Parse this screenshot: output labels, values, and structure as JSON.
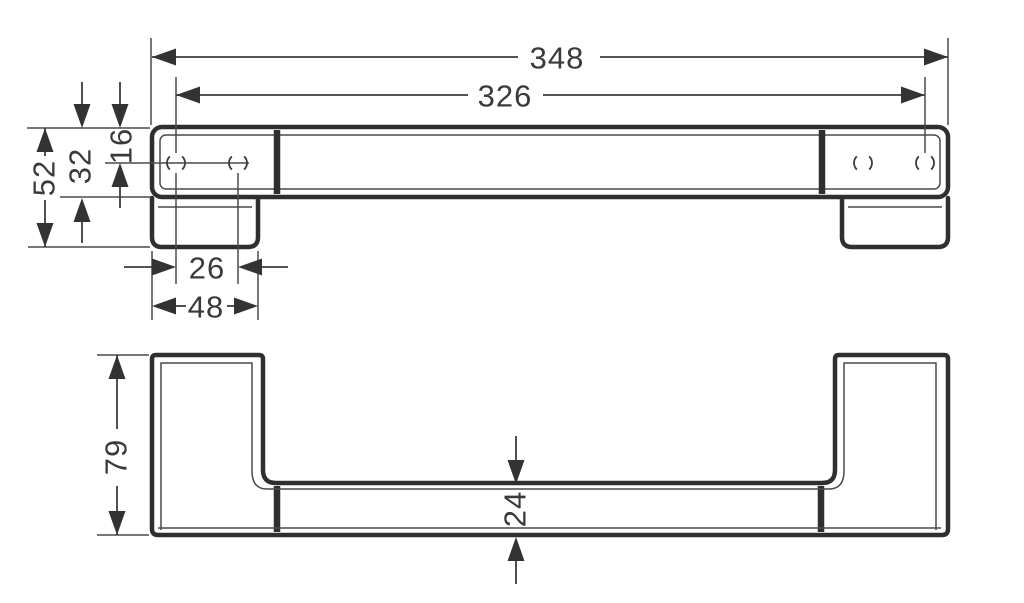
{
  "diagram": {
    "background": "#ffffff",
    "line_color": "#2f2f2f",
    "dimension_color": "#3c3c3c",
    "text_color": "#3a3a3a",
    "views": {
      "front": {
        "dims": {
          "overall_width": "348",
          "hole_span": "326",
          "end_height": "52",
          "bar_height": "32",
          "hole_offset": "16",
          "hole_pitch": "26",
          "plate_width": "48"
        }
      },
      "side": {
        "dims": {
          "overall_depth": "79",
          "bar_thickness": "24"
        }
      }
    }
  }
}
